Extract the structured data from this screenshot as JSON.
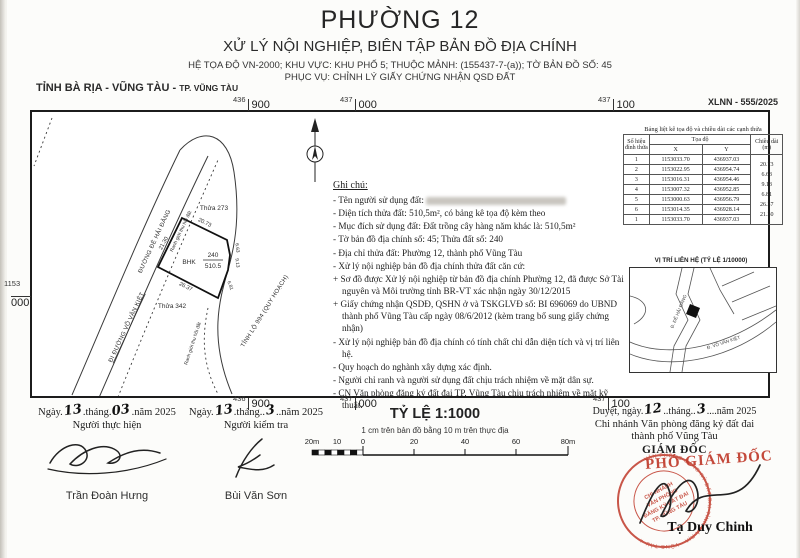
{
  "header": {
    "title": "PHƯỜNG 12",
    "subtitle": "XỬ LÝ NỘI NGHIỆP, BIÊN TẬP BẢN ĐỒ ĐỊA CHÍNH",
    "line3": "HỆ TỌA ĐỘ VN-2000; KHU VỰC: KHU PHỐ 5; THUỘC MẢNH: (155437-7-(a)); TỜ BẢN ĐỒ SỐ: 45",
    "line4": "PHỤC VỤ: CHỈNH LÝ GIẤY CHỨNG NHẬN QSD ĐẤT",
    "province": "TỈNH BÀ RỊA - VŨNG TÀU",
    "dash": " - ",
    "city": "TP. VŨNG TÀU",
    "doc_no": "XLNN - 555/2025"
  },
  "map": {
    "grid": {
      "top": [
        [
          "436",
          "900"
        ],
        [
          "437",
          "000"
        ],
        [
          "437",
          "100"
        ]
      ],
      "bottom": [
        [
          "436",
          "900"
        ],
        [
          "437",
          "000"
        ],
        [
          "437",
          "100"
        ]
      ],
      "left": [
        "1153",
        "000"
      ],
      "right": [
        "1153",
        "000"
      ]
    },
    "labels": {
      "thua273": "Thửa 273",
      "thua342": "Thửa 342",
      "road_vvk": "ĐI ĐƯỜNG VÕ VĂN KIỆT",
      "road_hd": "ĐƯỜNG ĐÊ HẢI ĐĂNG",
      "boundary": "Ranh giới thu hồi đất",
      "tinhlo": "TỈNH LỘ 994 (QUY HOẠCH)"
    },
    "parcel": {
      "use": "BHK",
      "number": "240",
      "area": "510.5"
    },
    "dims": {
      "top": "20.73",
      "left": "21.30",
      "bottom": "26.37",
      "r1": "6.63",
      "r2": "9.13",
      "r3": "6.81"
    }
  },
  "coord_table": {
    "title": "Bảng liệt kê tọa độ và chiều dài các cạnh thửa",
    "col_point": "Số hiệu đỉnh thửa",
    "col_coord": "Tọa độ",
    "col_x": "X",
    "col_y": "Y",
    "col_len": "Chiều dài (m)",
    "rows": [
      [
        "1",
        "1153033.70",
        "436937.03"
      ],
      [
        "2",
        "1153022.95",
        "436954.74"
      ],
      [
        "3",
        "1153016.31",
        "436954.46"
      ],
      [
        "4",
        "1153007.32",
        "436952.85"
      ],
      [
        "5",
        "1153000.63",
        "436956.79"
      ],
      [
        "6",
        "1153014.35",
        "436928.14"
      ],
      [
        "1",
        "1153033.70",
        "436937.03"
      ]
    ],
    "lengths": [
      "20.73",
      "6.63",
      "9.13",
      "6.81",
      "26.37",
      "21.30"
    ]
  },
  "loc_map": {
    "title": "VỊ TRÍ LIÊN HỆ (TỶ LỆ 1/10000)",
    "road1": "Đ. ĐÊ HẢI ĐĂNG",
    "road2": "Đ. VÕ VĂN KIỆT"
  },
  "notes": {
    "title": "Ghi chú:",
    "lines": [
      "- Tên người sử dụng đất:",
      "- Diện tích thửa đất: 510,5m², có bảng kê tọa độ kèm theo",
      "- Mục đích sử dụng đất: Đất trồng cây hàng năm khác là: 510,5m²",
      "- Tờ bản đồ địa chính số: 45; Thửa đất số: 240",
      "- Địa chỉ thửa đất: Phường 12, thành phố Vũng Tàu",
      "- Xử lý nội nghiệp bản đồ địa chính thửa đất căn cứ:",
      "+ Sơ đồ được Xử lý nội nghiệp từ bản đồ địa chính Phường 12, đã được Sở Tài nguyên và Môi trường tỉnh BR-VT xác nhận ngày 30/12/2015",
      "+ Giấy chứng nhận QSDĐ, QSHN ở và TSKGLVĐ số: BI 696069 do UBND thành phố Vũng Tàu cấp ngày 08/6/2012 (kèm trang bổ sung giấy chứng nhận)",
      "- Xử lý nội nghiệp bản đồ địa chính có tính chất chỉ dẫn diện tích và vị trí liên hệ.",
      "- Quy hoạch do nghành xây dựng xác định.",
      "- Người chỉ ranh và người sử dụng đất chịu trách nhiệm về mặt dân sự.",
      "- CN Văn phòng đăng ký đất đai TP. Vũng Tàu chịu trách nhiệm về mặt kỹ thuật."
    ]
  },
  "footer": {
    "exec": {
      "date_parts": [
        "Ngày.",
        "13",
        ".tháng.",
        "03",
        ".năm 2025"
      ],
      "role": "Người thực hiện",
      "name": "Trần Đoàn Hưng"
    },
    "check": {
      "date_parts": [
        "Ngày.",
        "13",
        ".tháng..",
        "3",
        "..năm 2025"
      ],
      "role": "Người kiểm tra",
      "name": "Bùi Văn Sơn"
    },
    "scale": {
      "title": "TỶ LỆ 1:1000",
      "caption": "1 cm trên bản đồ bằng 10 m trên thực địa",
      "ticks": [
        "20m",
        "10",
        "0",
        "20",
        "40",
        "60",
        "80m"
      ]
    },
    "approve": {
      "date_parts": [
        "Duyệt, ngày.",
        "12",
        "..tháng..",
        "3",
        "....năm 2025"
      ],
      "org1": "Chi nhánh Văn phòng đăng ký đất đai",
      "org2": "thành phố Vũng Tàu",
      "title": "GIÁM ĐỐC",
      "overlay": "PHÓ GIÁM ĐỐC",
      "name": "Tạ Duy Chinh"
    }
  },
  "stamp": {
    "ring": "VĂN PHÒNG ĐĂNG KÝ ĐẤT ĐAI TỈNH BÀ RỊA - VŨNG TÀU ★",
    "center": [
      "CHI NHÁNH",
      "VĂN PHÒNG",
      "ĐĂNG KÝ ĐẤT ĐAI",
      "TP. VŨNG TÀU"
    ],
    "color": "#c03a2b"
  }
}
